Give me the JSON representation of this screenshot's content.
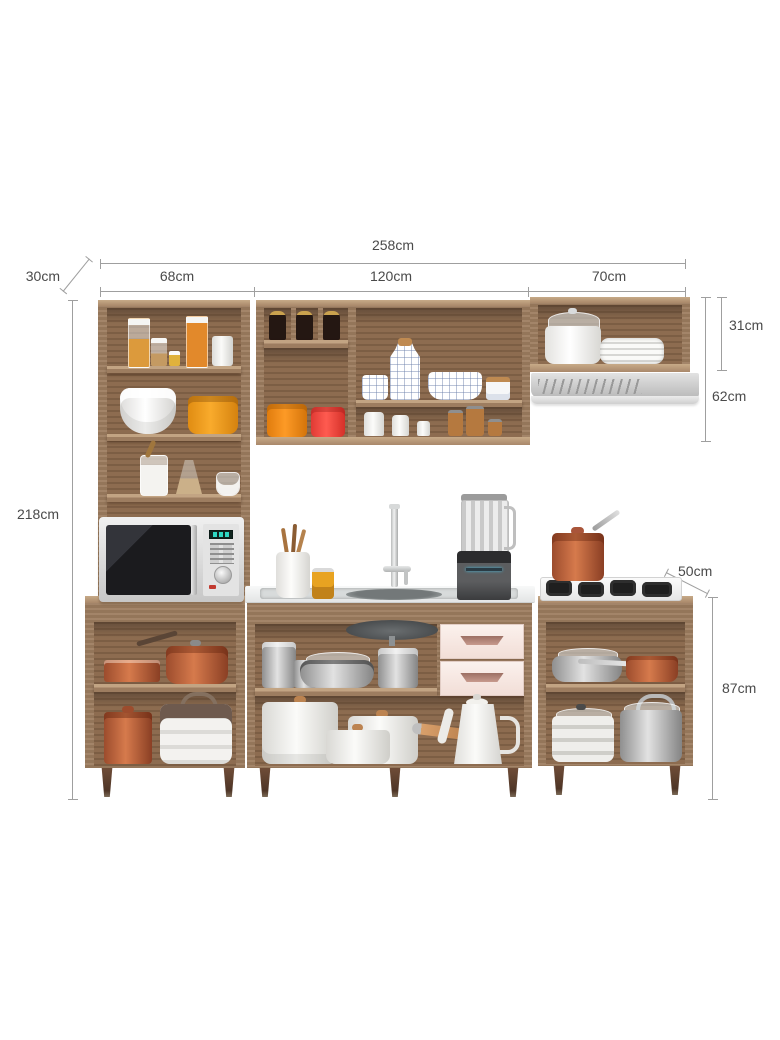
{
  "dims": {
    "total_width": "258cm",
    "left_width": "68cm",
    "middle_width": "120cm",
    "right_width": "70cm",
    "wall_depth": "30cm",
    "wall_height": "31cm",
    "wall_hood_height": "62cm",
    "total_height": "218cm",
    "base_depth": "50cm",
    "base_height": "87cm"
  },
  "colors": {
    "wood": "#9d7d60",
    "wood_interior": "#8d6c50",
    "drawer_pink": "#f8ebe5",
    "drawer_handle": "#b98a7f",
    "hood_gray": "#c6c6c6",
    "dimension_line": "#9f9f9f",
    "dimension_text": "#4a4a4a",
    "copper": "#c06a45",
    "canister_orange": "#f7a11c",
    "canister_red": "#f8473e",
    "microwave_display_teal": "#2ed8c3"
  }
}
